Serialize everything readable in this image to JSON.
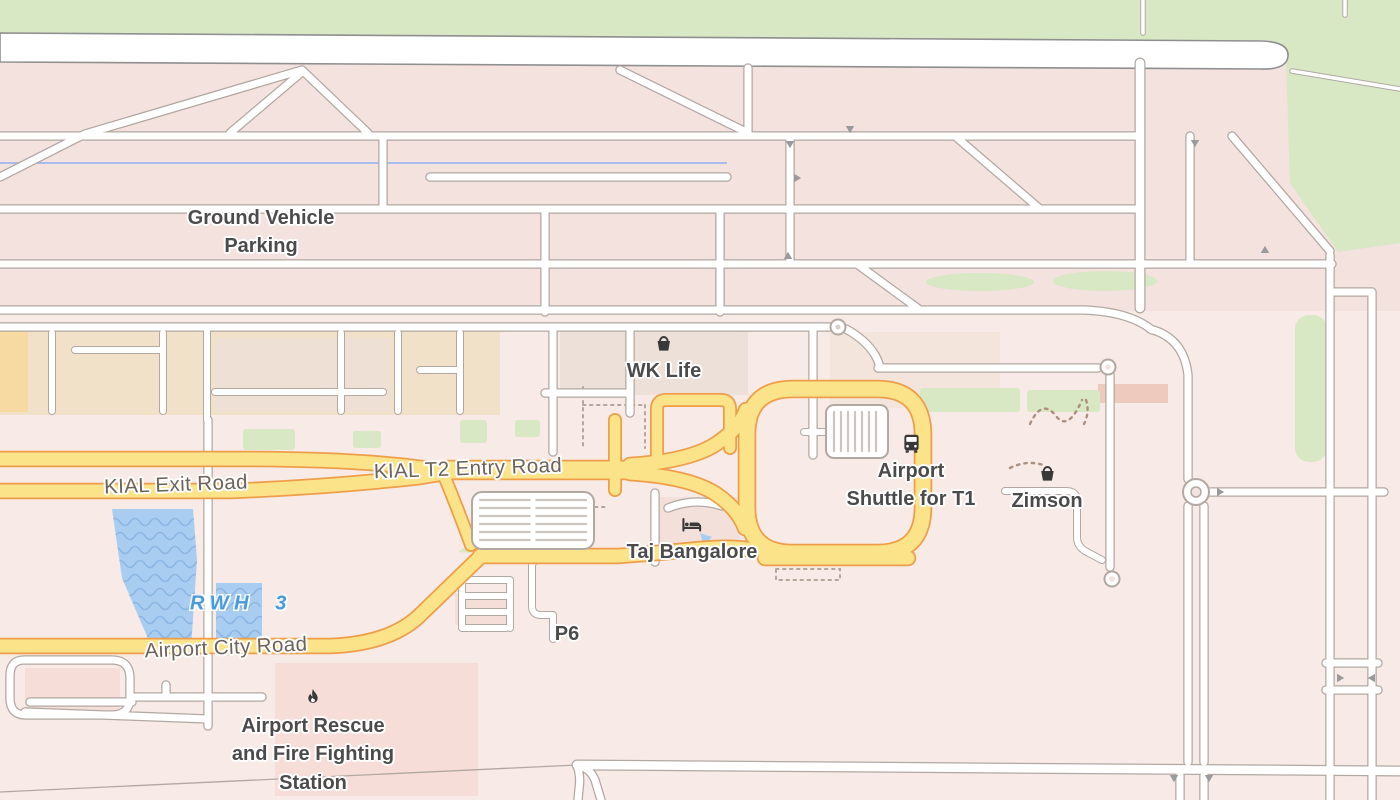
{
  "map": {
    "pois": {
      "ground_vehicle_parking": {
        "label": "Ground Vehicle Parking"
      },
      "wk_life": {
        "label": "WK Life",
        "icon": "shopping-basket-icon"
      },
      "airport_shuttle_t1": {
        "label": "Airport Shuttle for T1",
        "icon": "bus-icon"
      },
      "zimson": {
        "label": "Zimson",
        "icon": "shopping-basket-icon"
      },
      "taj_bangalore": {
        "label": "Taj Bangalore",
        "icon": "hotel-bed-icon"
      },
      "fire_station": {
        "label": "Airport Rescue and Fire Fighting Station",
        "icon": "fire-icon"
      },
      "p6": {
        "label": "P6"
      }
    },
    "roads": {
      "kial_exit": {
        "label": "KIAL Exit Road"
      },
      "kial_t2_entry": {
        "label": "KIAL T2 Entry Road"
      },
      "airport_city": {
        "label": "Airport City Road"
      }
    },
    "water": {
      "rwh3": {
        "label": "RWH 3"
      }
    },
    "colors": {
      "base_pink": "#f8eae6",
      "apron": "#f4e2de",
      "green": "#d8e7c4",
      "road_casing": "#b2a8a2",
      "yellow_fill": "#fbe38a",
      "yellow_casing": "#ee9e49",
      "water": "#a9cdf1",
      "water_wave": "#8cb6e3",
      "poi_label": "#4b4b4b",
      "road_label": "#6e6259",
      "water_label": "#4a9bd9",
      "icon_dark": "#383838"
    }
  }
}
